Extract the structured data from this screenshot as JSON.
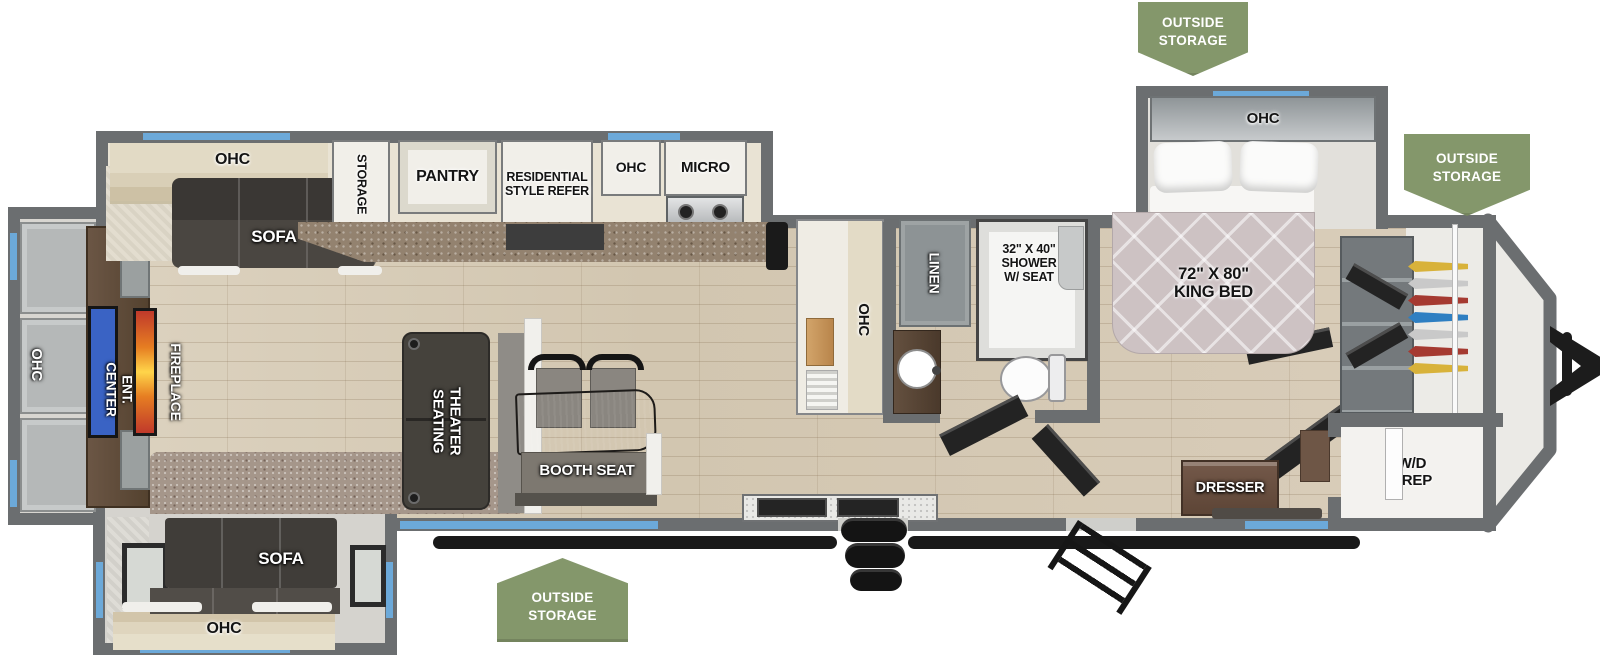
{
  "plan": {
    "badges": {
      "top": "OUTSIDE\nSTORAGE",
      "front": "OUTSIDE\nSTORAGE",
      "bottom": "OUTSIDE\nSTORAGE"
    },
    "rear": {
      "ohc": "OHC",
      "ent_center": "ENT. CENTER",
      "fireplace": "FIREPLACE"
    },
    "living": {
      "ohc_top": "OHC",
      "sofa_top": "SOFA",
      "storage": "STORAGE",
      "theater": "THEATER\nSEATING",
      "booth_seat": "BOOTH SEAT",
      "sofa_bottom": "SOFA",
      "ohc_bottom": "OHC"
    },
    "kitchen": {
      "pantry": "PANTRY",
      "refer": "RESIDENTIAL\nSTYLE REFER",
      "ohc": "OHC",
      "micro": "MICRO",
      "hutch_ohc": "OHC"
    },
    "bath": {
      "linen": "LINEN",
      "shower": "32\" X 40\"\nSHOWER\nW/ SEAT"
    },
    "bedroom": {
      "ohc": "OHC",
      "king_bed": "72\" X 80\"\nKING BED",
      "dresser": "DRESSER"
    },
    "front": {
      "wd_prep": "W/D\nPREP"
    },
    "colors": {
      "badge_green": "#84976b",
      "accent_blue": "#6ca9d9",
      "wall_gray": "#6b6e70",
      "tv_blue": "#3a63c4",
      "fire_orange": "#e8742c"
    }
  }
}
